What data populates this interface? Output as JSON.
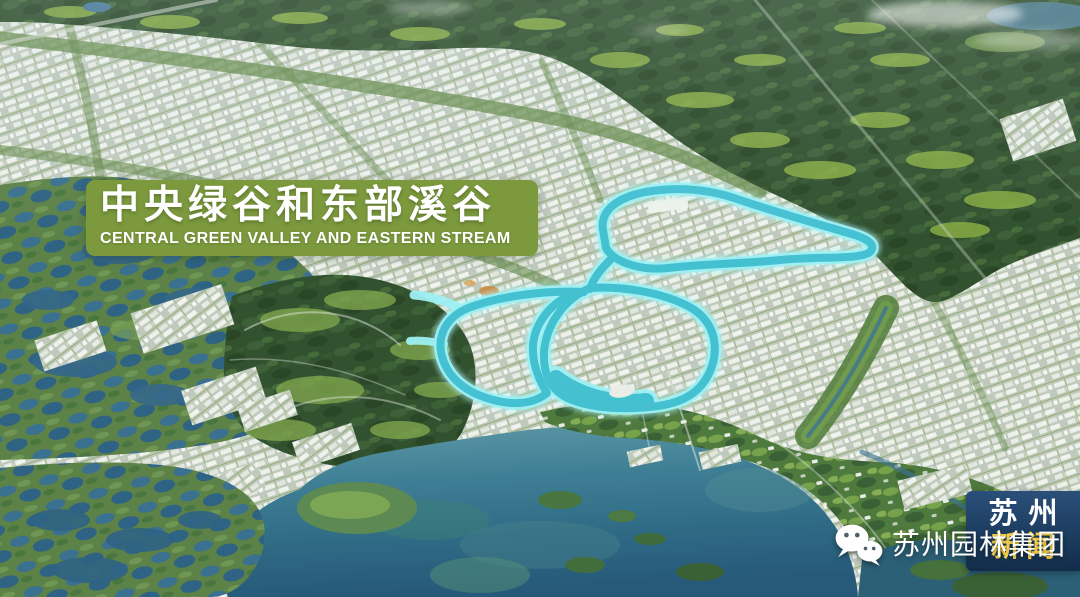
{
  "scene": {
    "type": "aerial-masterplan-rendering",
    "colors": {
      "banner_green": "#7c993e",
      "highlight_cyan": "#9df0f3",
      "highlight_teal": "#35b9cc",
      "lake_teal": "#35788e",
      "forest_dark": "#31512f",
      "urban_light": "#e9ede5",
      "logo_navy": "#1d3d60",
      "logo_yellow": "#ffd84d"
    }
  },
  "banner": {
    "title_zh": "中央绿谷和东部溪谷",
    "title_en": "CENTRAL GREEN VALLEY AND EASTERN STREAM"
  },
  "watermark": {
    "icon": "wechat-icon",
    "text": "苏州园林集团"
  },
  "station_logo": {
    "line1": "苏州",
    "line2": "新闻"
  }
}
